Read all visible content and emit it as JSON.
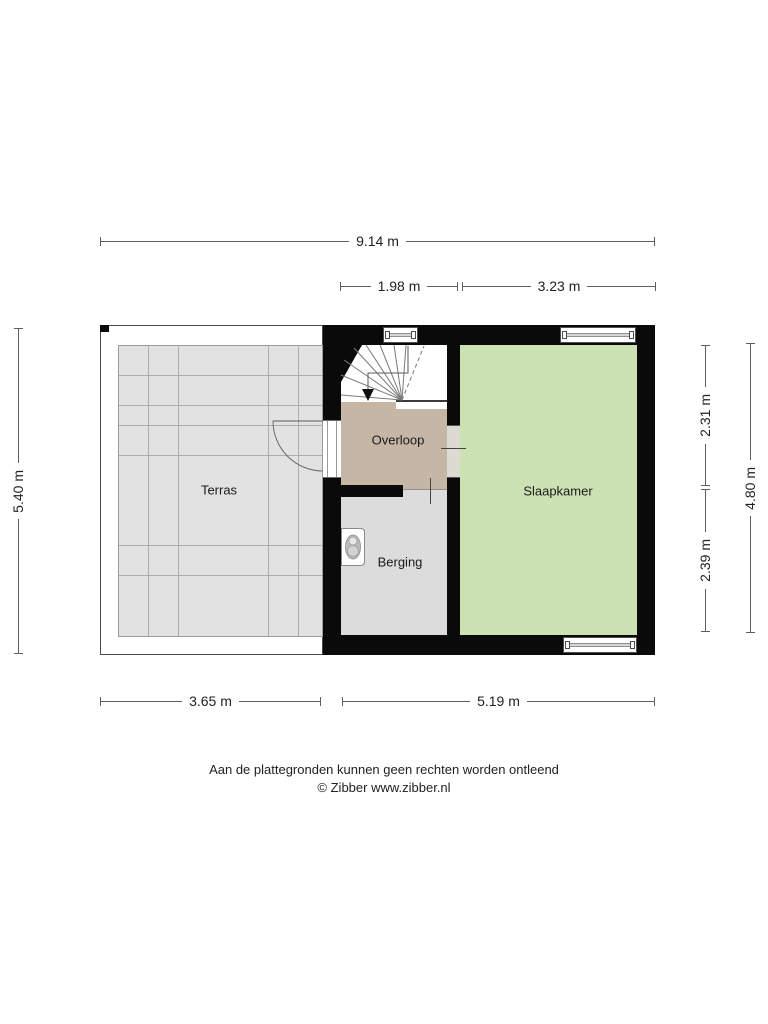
{
  "plan": {
    "rooms": [
      {
        "id": "terras",
        "label": "Terras"
      },
      {
        "id": "overloop",
        "label": "Overloop"
      },
      {
        "id": "slaapkamer",
        "label": "Slaapkamer"
      },
      {
        "id": "berging",
        "label": "Berging"
      }
    ],
    "dimensions": {
      "top_total": "9.14 m",
      "top_overloop": "1.98 m",
      "top_slaapkamer": "3.23 m",
      "left_total": "5.40 m",
      "right_upper": "2.31 m",
      "right_lower": "2.39 m",
      "right_total": "4.80 m",
      "bottom_terras": "3.65 m",
      "bottom_main": "5.19 m"
    },
    "icons": {
      "stair_direction_arrow": "triangle-down",
      "boiler_unit": "wall-mounted-boiler"
    },
    "colors": {
      "wall": "#0a0a0a",
      "terras_floor": "#e2e2e2",
      "overloop_floor": "#c5b6a5",
      "slaapkamer_floor": "#cde2b2",
      "berging_floor": "#dcdcdc"
    }
  },
  "footer": {
    "disclaimer": "Aan de plattegronden kunnen geen rechten worden ontleend",
    "credit": "© Zibber www.zibber.nl"
  }
}
